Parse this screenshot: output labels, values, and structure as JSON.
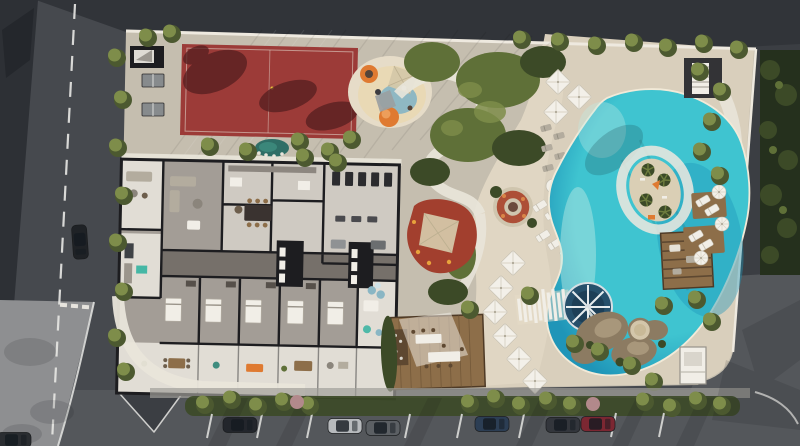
{
  "meta": {
    "description": "Aerial 3D architectural rendering of a residential complex site plan with amenity floor plan, sports court, playground, lagoon pool and street parking",
    "width": 800,
    "height": 446
  },
  "scene": {
    "features": [
      "sports-court",
      "table-tennis-tables",
      "playground",
      "shade-sail",
      "kids-splash-area",
      "fire-pit-lounge",
      "lagoon-pool",
      "pool-island",
      "lazy-river-ring",
      "water-wheel",
      "slat-bridge",
      "beach-umbrellas",
      "sun-loungers",
      "rock-spa",
      "pergola-lounge",
      "lounger-decks",
      "dining-deck",
      "bar-kiosk",
      "amenity-floor-plan",
      "elevator-cores",
      "gym-room",
      "apartment-terraces",
      "pond-stepping-stones",
      "street-parking",
      "parked-cars",
      "street-trees",
      "traffic-island",
      "crosswalk",
      "perimeter-wall"
    ]
  },
  "street": {
    "cars": [
      {
        "color": "#23262c"
      },
      {
        "color": "#b7babd"
      },
      {
        "color": "#5c6064"
      },
      {
        "color": "#2c3e54"
      },
      {
        "color": "#33363c"
      },
      {
        "color": "#7c2732"
      },
      {
        "color": "#1f2226"
      },
      {
        "color": "#2a2d31"
      }
    ]
  },
  "colors": {
    "asphalt": "#46494e",
    "asphaltTop": "#313439",
    "asphaltRight": "#3b3e43",
    "roadBottom": "#54575b",
    "plaza": "#2d3035",
    "plazaCorner": "#8e8f91",
    "ground": "#c5beaf",
    "sand": "#d9cfbc",
    "sandBright": "#e6dcc8",
    "pathLight": "#e9e5da",
    "wallLine": "#eee9df",
    "lineWhite": "#e8e8e5",
    "court": "#9c3b38",
    "courtShadow": "#571f20",
    "kidsRed": "#a23f2e",
    "firepit": "#ad4f37",
    "orange": "#df7a31",
    "playCream": "#e9d9b5",
    "playBlue": "#8ab6c4",
    "canopy": "#d5c8a9",
    "pool1": "#bfeae4",
    "pool2": "#3fc4d0",
    "pool3": "#1f95b8",
    "poolRing": "#8fdfdf",
    "islandSand": "#dacfb5",
    "tree": "#7e8d4a",
    "treeDark": "#4c5930",
    "treePink": "#b2898b",
    "hedge": "#25301d",
    "shrub": "#5f7038",
    "shrubDark": "#3c4a27",
    "wood": "#8d6e49",
    "woodDark": "#5e4831",
    "wall": "#1d1d20",
    "floor": "#a39d96",
    "floorLight": "#cfcac2",
    "corridor": "#76706a",
    "terrace": "#e1ddd5",
    "white": "#f1eee7",
    "umbrella": "#f3f0e9",
    "grayFurn": "#b3ac9e",
    "splash": "#26506b",
    "splashDeep": "#1d3f57",
    "rock": "#8c7b62",
    "rockLight": "#a8977b",
    "spa": "#d3c6aa",
    "shadow": "#14161a"
  }
}
